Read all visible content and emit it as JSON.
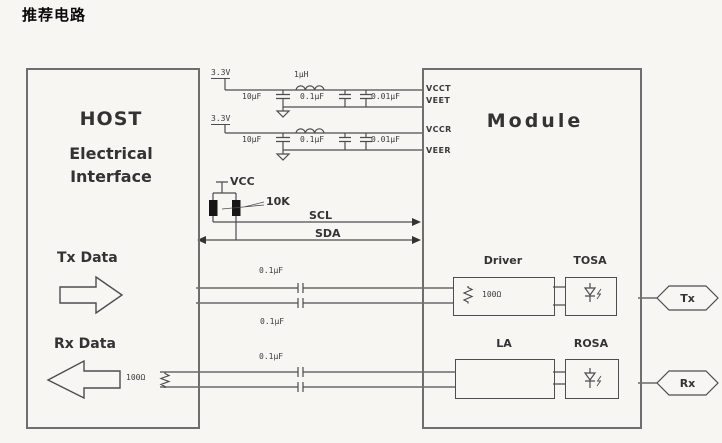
{
  "page": {
    "title": "推荐电路"
  },
  "colors": {
    "background": "#f7f6f2",
    "line": "#4d4d4d",
    "box_border": "#6e6e6e",
    "text": "#2d2d2d",
    "resistor_fill": "#161616"
  },
  "host": {
    "title": "HOST",
    "subtitle": [
      "Electrical",
      "Interface"
    ],
    "tx_label": "Tx Data",
    "rx_label": "Rx Data",
    "rx_termination": "100Ω"
  },
  "module": {
    "title": "Module",
    "ports": {
      "vcct": "VCCT",
      "veet": "VEET",
      "vccr": "VCCR",
      "veer": "VEER"
    },
    "driver": {
      "label": "Driver",
      "resistor": "100Ω"
    },
    "tosa": {
      "label": "TOSA"
    },
    "la": {
      "label": "LA"
    },
    "rosa": {
      "label": "ROSA"
    }
  },
  "filter_tx": {
    "supply": "3.3V",
    "cap1": "10μF",
    "inductor": "1μH",
    "cap2": "0.1μF",
    "cap3": "0.01μF"
  },
  "filter_rx": {
    "supply": "3.3V",
    "cap1": "10μF",
    "cap2": "0.1μF",
    "cap3": "0.01μF"
  },
  "i2c": {
    "vcc": "VCC",
    "pullups": "10K",
    "scl": "SCL",
    "sda": "SDA"
  },
  "tx_path": {
    "cap_top": "0.1μF",
    "cap_bottom": "0.1μF",
    "port": "Tx"
  },
  "rx_path": {
    "cap_top": "0.1μF",
    "port": "Rx"
  }
}
